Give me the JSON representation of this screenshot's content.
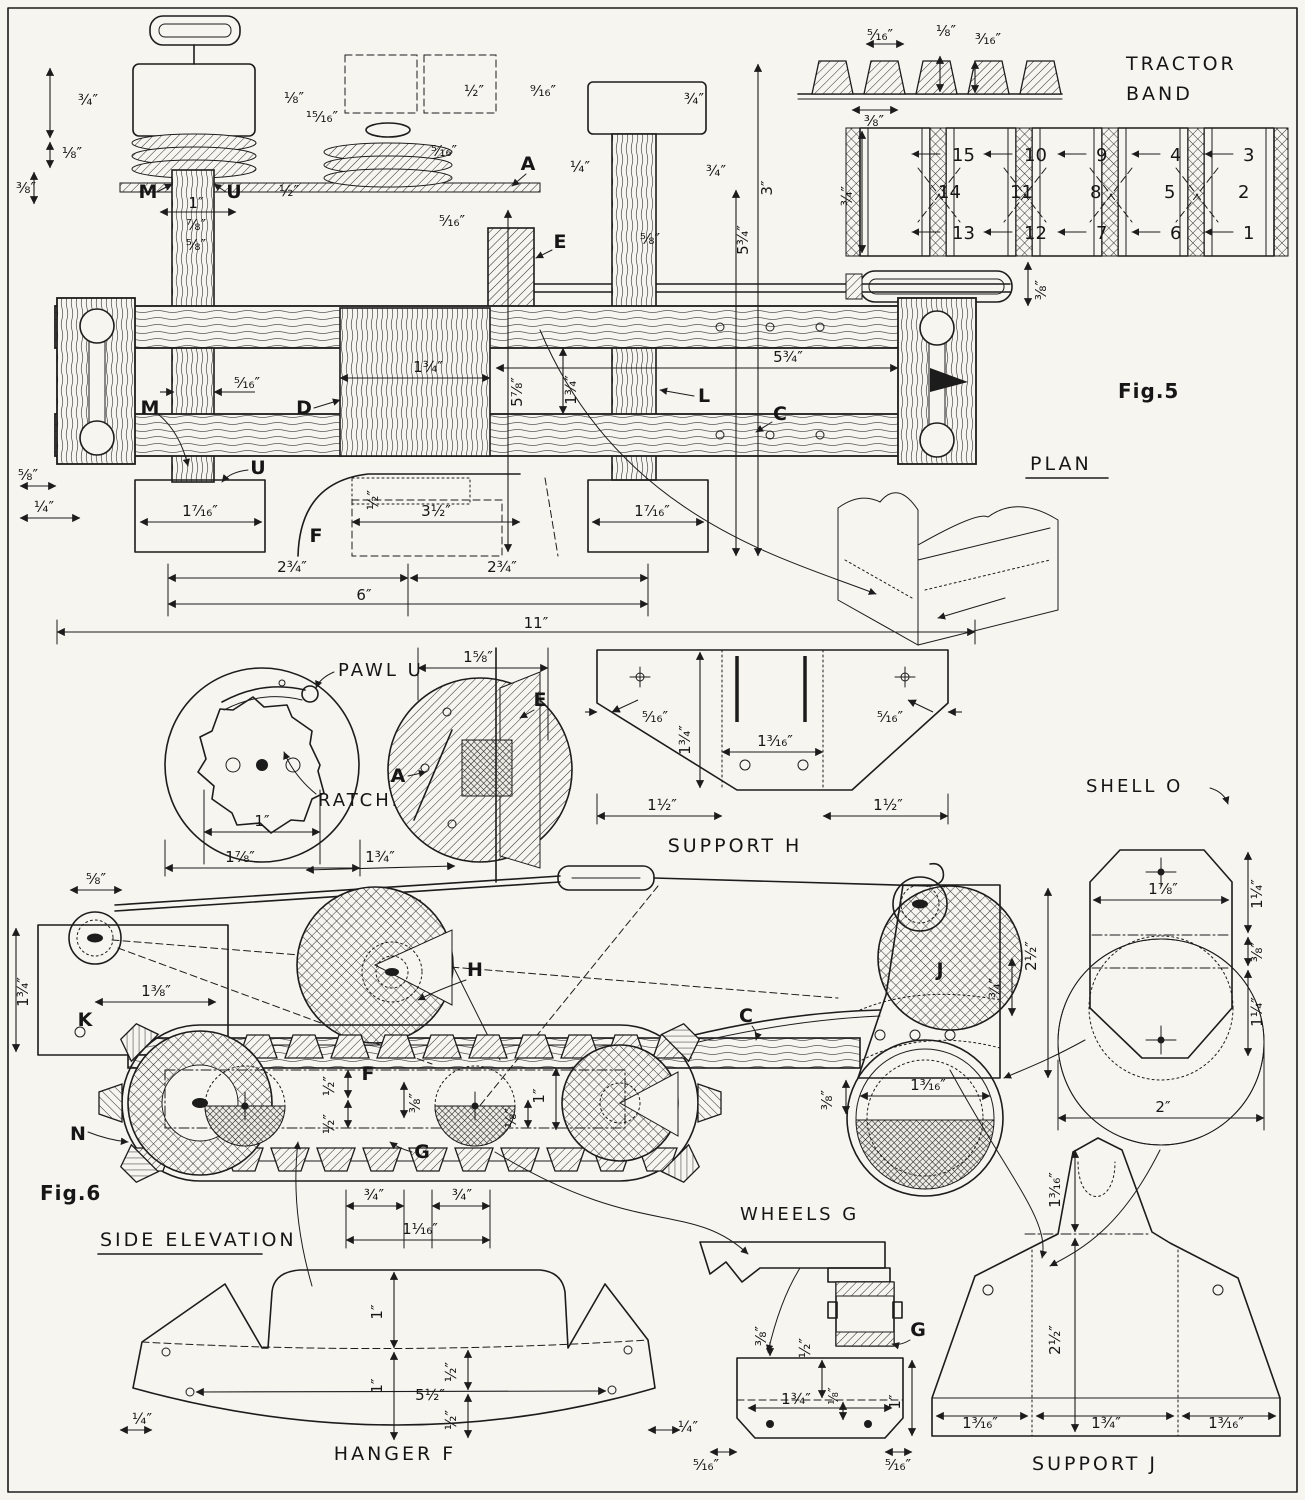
{
  "titles": {
    "fig5": "Fig.5",
    "plan": "PLAN",
    "fig6": "Fig.6",
    "side_elevation": "SIDE ELEVATION",
    "tractor_band_line1": "TRACTOR",
    "tractor_band_line2": "BAND",
    "pawl": "PAWL U",
    "ratchet": "RATCHET M",
    "support_h": "SUPPORT H",
    "shell_o": "SHELL O",
    "wheels_g": "WHEELS G",
    "hanger_f": "HANGER F",
    "support_j": "SUPPORT J"
  },
  "part_labels": {
    "m1": "M",
    "u1": "U",
    "a1": "A",
    "e1": "E",
    "m2": "M",
    "d": "D",
    "l": "L",
    "c1": "C",
    "u2": "U",
    "f1": "F",
    "a2": "A",
    "e2": "E",
    "k": "K",
    "n": "N",
    "f2": "F",
    "g1": "G",
    "h": "H",
    "c2": "C",
    "j": "J",
    "g2": "G"
  },
  "band": {
    "numbers": [
      "15",
      "10",
      "9",
      "4",
      "3",
      "14",
      "11",
      "8",
      "5",
      "2",
      "13",
      "12",
      "7",
      "6",
      "1"
    ],
    "dims": {
      "tread_pitch": "⁵⁄₁₆″",
      "tread_top": "⅛″",
      "tread_height": "³⁄₁₆″",
      "tread_base": "⅜″",
      "band_width": "¾″",
      "gap": "⅜″"
    }
  },
  "dims": {
    "plan": [
      "¾″",
      "⅛″",
      "⅜″",
      "1″",
      "⅞″",
      "⅝″",
      "⅛″",
      "¹⁵⁄₁₆″",
      "½″",
      "⁵⁄₁₆″",
      "⁵⁄₁₆″",
      "½″",
      "⁹⁄₁₆″",
      "¼″",
      "¾″",
      "¾″",
      "3″",
      "5¾″",
      "⅝″",
      "⁵⁄₁₆″",
      "1¾″",
      "5⅞″",
      "1¾″",
      "5¾″",
      "⅝″",
      "¼″",
      "1⁷⁄₁₆″",
      "½″",
      "3½″",
      "1⁷⁄₁₆″",
      "2¾″",
      "2¾″",
      "6″",
      "11″"
    ],
    "ratchet": [
      "1″",
      "1⅞″"
    ],
    "support_h": [
      "1⅝″",
      "⁵⁄₁₆″",
      "1¾″",
      "1³⁄₁₆″",
      "⁵⁄₁₆″",
      "1½″",
      "1½″"
    ],
    "shell_o": [
      "1⅞″",
      "1¼″",
      "⅜″",
      "1¼″",
      "2″"
    ],
    "side": [
      "⅝″",
      "1¾″",
      "1¾″",
      "1⅜″",
      "½″",
      "½″",
      "⅜″",
      "1″",
      "⅛″",
      "¾″",
      "¾″",
      "1¹⁄₁₆″",
      "¾″",
      "2½″",
      "⅜″",
      "1³⁄₁₆″"
    ],
    "wheels_g": [
      "⅜″",
      "½″",
      "1¾″",
      "⅛″",
      "1″",
      "⁵⁄₁₆″",
      "⁵⁄₁₆″"
    ],
    "hanger_f": [
      "1″",
      "1″",
      "5½″",
      "½″",
      "½″",
      "¼″",
      "¼″"
    ],
    "support_j": [
      "1³⁄₁₆″",
      "2½″",
      "1³⁄₁₆″",
      "1¾″",
      "1³⁄₁₆″"
    ]
  }
}
